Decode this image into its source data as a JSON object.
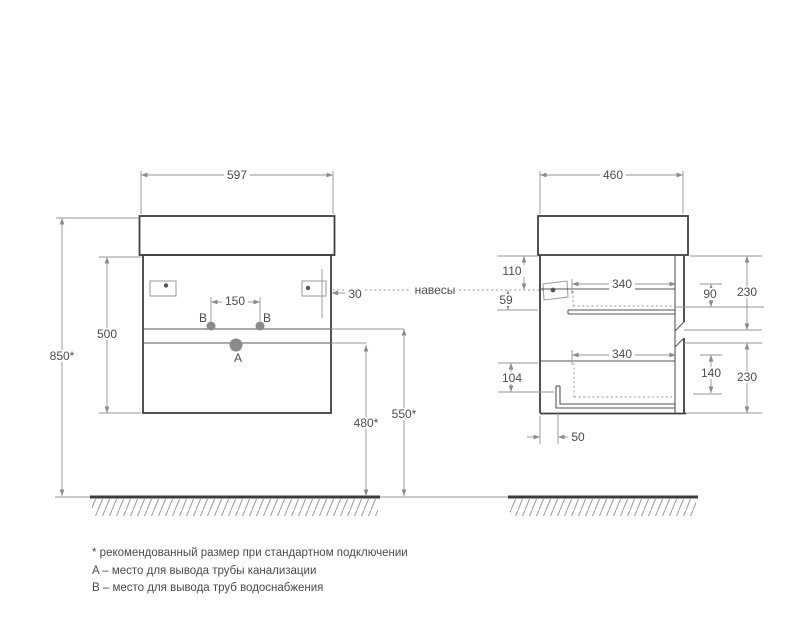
{
  "front_view": {
    "width": "597",
    "body_height": "500",
    "install_height": "850*",
    "hanger_inset": "30",
    "outlet_spacing": "150",
    "outlet_a_height": "480*",
    "outlet_b_height": "550*",
    "point_a": "A",
    "point_b": "B"
  },
  "side_view": {
    "depth": "460",
    "hanger_from_top": "110",
    "hanger_drop": "59",
    "top_drawer_depth": "340",
    "top_drawer_inner_height": "90",
    "top_front_height": "230",
    "bottom_drawer_depth": "340",
    "bottom_drawer_inner_height": "140",
    "bottom_front_height": "230",
    "bottom_inset": "104",
    "drain_offset": "50"
  },
  "callouts": {
    "hangers": "навесы"
  },
  "notes": {
    "recommended": "* рекомендованный размер при стандартном подключении",
    "a": "A – место для вывода трубы канализации",
    "b": "B – место для вывода труб водоснабжения"
  },
  "colors": {
    "outline": "#3f3f3f",
    "dimension_line": "#949494",
    "text": "#4d4d4d",
    "point_fill": "#8a8a8a"
  }
}
